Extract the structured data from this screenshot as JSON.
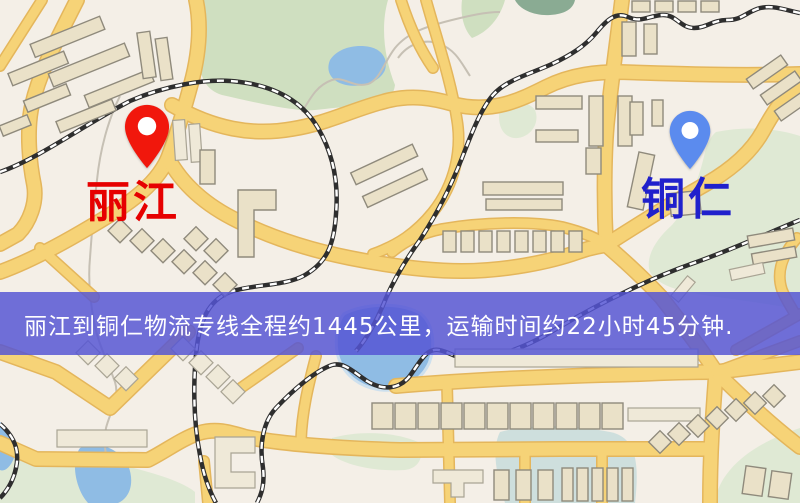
{
  "banner": {
    "text": "丽江到铜仁物流专线全程约1445公里，运输时间约22小时45分钟."
  },
  "markers": {
    "origin": {
      "label": "丽江",
      "pin": "red-map-pin"
    },
    "destination": {
      "label": "铜仁",
      "pin": "blue-map-pin"
    }
  },
  "map": {
    "palette": {
      "background": "#f4efe7",
      "road": "#f6d377",
      "road_casing": "#e4b65c",
      "park": "#cfdfc0",
      "park_light": "#dfe9d4",
      "water": "#8fbce4",
      "water_light": "#c3dcf0",
      "pond": "#8aab93",
      "building_fill": "#eae1c8",
      "building_stroke": "#8f8a7c",
      "rail": "#2e2e2e",
      "path": "#c6c0b4",
      "banner_bg": "rgba(85,85,212,0.84)",
      "banner_text": "#ffffff",
      "origin_pin": "#f1170c",
      "origin_label": "#e60000",
      "dest_pin": "#5b8bee",
      "dest_label": "#2020cc"
    }
  }
}
